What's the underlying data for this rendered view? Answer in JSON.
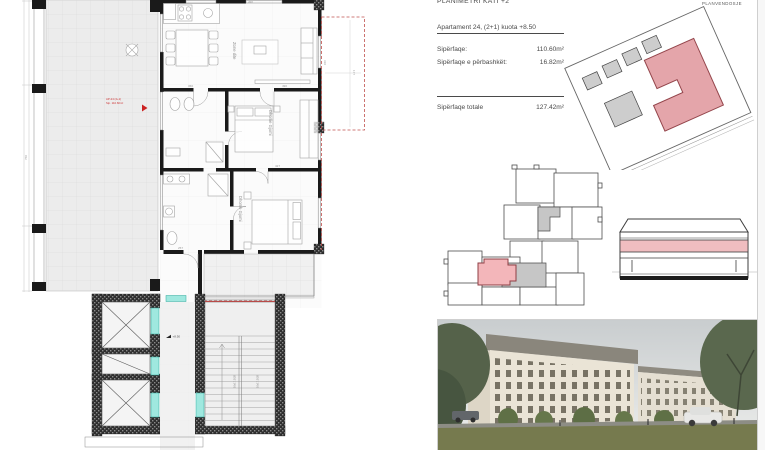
{
  "sheet": {
    "plan_title": "PLANIMETRI KATI +2",
    "siteplan_title": "PLANVENDOSJE"
  },
  "apartment": {
    "title": "Apartament 24, (2+1) kuota +8.50",
    "rows": [
      {
        "label": "Sipërfaqe:",
        "value": "110.60m²"
      },
      {
        "label": "Sipërfaqe e përbashkët:",
        "value": "16.82m²"
      }
    ],
    "total_label": "Sipërfaqe totale",
    "total_value": "127.42m²"
  },
  "floorplan": {
    "room_labels": {
      "living": "Zone dite",
      "bedroom1": "Dhome Gjumi",
      "bedroom2": "Dhome Gjumi"
    },
    "unit_marker": {
      "line1": "AP-24 (2+1)",
      "line2": "Sip. 110.60m²"
    },
    "level_note": "+8.50",
    "stair_note1": "16x17.5/28",
    "stair_note2": "16x17.5/28",
    "dims": [
      "366",
      "490",
      "427",
      "257",
      "310",
      "760",
      "177",
      "490"
    ]
  },
  "colors": {
    "highlight_pink": "#e4a5aa",
    "keyplan_pink": "#f3b6ba",
    "elevation_pink": "#f0bdc0",
    "gray_mass": "#cdcdcd",
    "red_dashed": "#c0504d",
    "teal_opening": "#9fe8df",
    "wall_black": "#1a1a1a"
  }
}
